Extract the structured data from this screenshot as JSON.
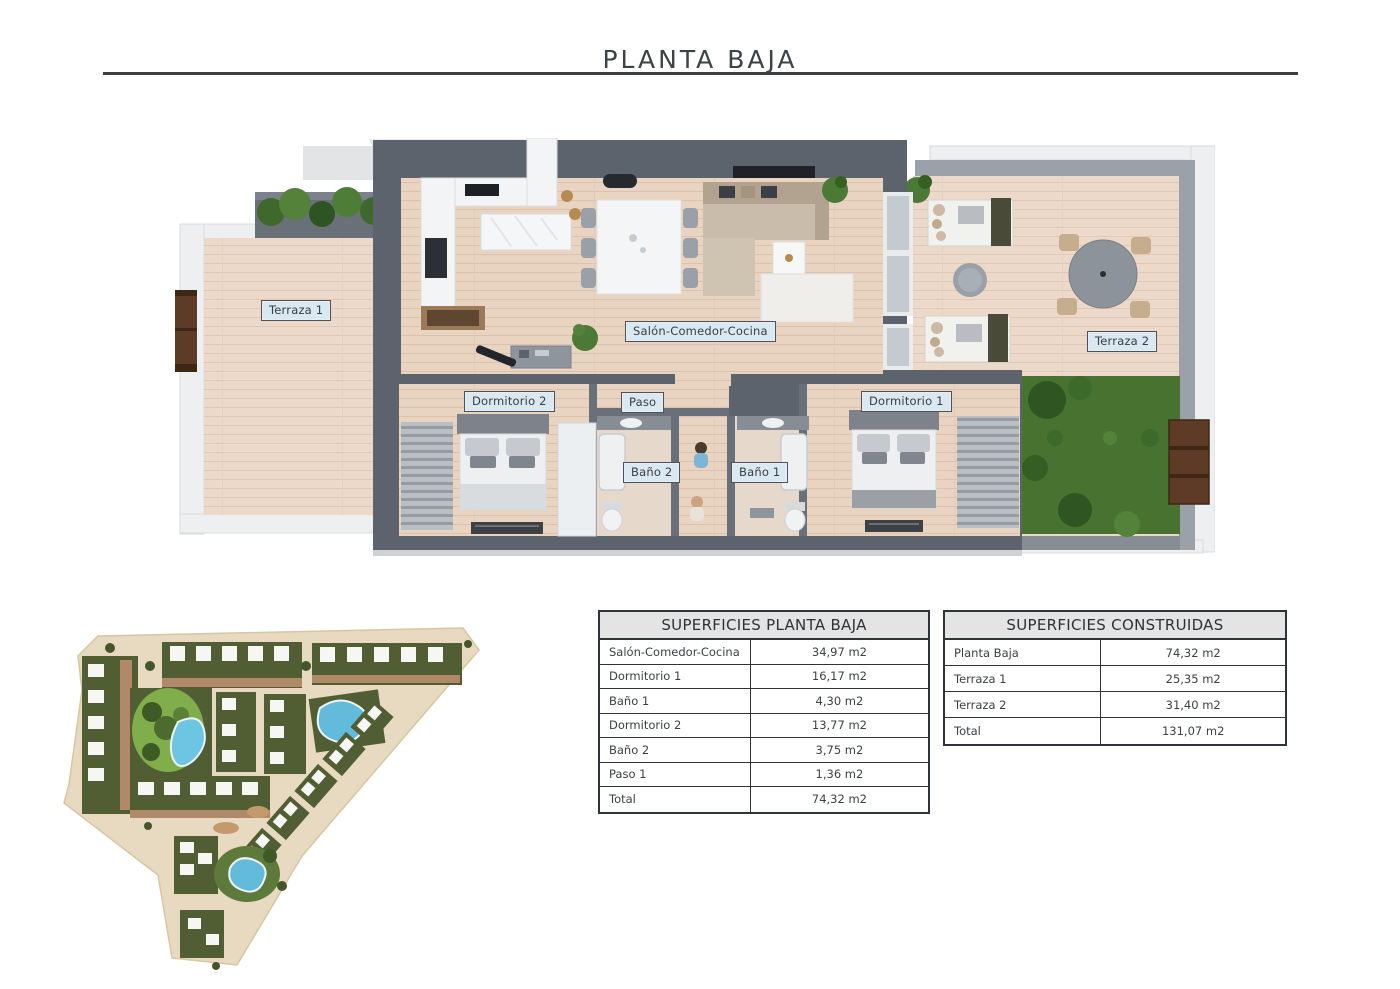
{
  "page": {
    "title": "PLANTA BAJA"
  },
  "floor_plan": {
    "labels": [
      {
        "id": "terraza-1",
        "text": "Terraza 1"
      },
      {
        "id": "salon",
        "text": "Salón-Comedor-Cocina"
      },
      {
        "id": "terraza-2",
        "text": "Terraza 2"
      },
      {
        "id": "dormitorio-2",
        "text": "Dormitorio 2"
      },
      {
        "id": "paso",
        "text": "Paso"
      },
      {
        "id": "dormitorio-1",
        "text": "Dormitorio 1"
      },
      {
        "id": "bano-2",
        "text": "Baño 2"
      },
      {
        "id": "bano-1",
        "text": "Baño 1"
      }
    ]
  },
  "tables": {
    "planta_baja": {
      "title": "SUPERFICIES PLANTA BAJA",
      "rows": [
        {
          "label": "Salón-Comedor-Cocina",
          "value": "34,97 m2"
        },
        {
          "label": "Dormitorio 1",
          "value": "16,17 m2"
        },
        {
          "label": "Baño 1",
          "value": "4,30 m2"
        },
        {
          "label": "Dormitorio 2",
          "value": "13,77 m2"
        },
        {
          "label": "Baño 2",
          "value": "3,75 m2"
        },
        {
          "label": "Paso 1",
          "value": "1,36 m2"
        },
        {
          "label": "Total",
          "value": "74,32 m2"
        }
      ]
    },
    "construidas": {
      "title": "SUPERFICIES CONSTRUIDAS",
      "rows": [
        {
          "label": "Planta Baja",
          "value": "74,32 m2"
        },
        {
          "label": "Terraza 1",
          "value": "25,35 m2"
        },
        {
          "label": "Terraza 2",
          "value": "31,40 m2"
        },
        {
          "label": "Total",
          "value": "131,07 m2"
        }
      ]
    }
  },
  "colors": {
    "label_bg": "#d9e8f1",
    "wall_dark": "#5d636c",
    "wall_mid": "#9ba1a9",
    "wood_floor": "#e9d3c1",
    "terrace_wood": "#ecd9ca",
    "grass": "#48722f",
    "pool_blue": "#62bbdb",
    "site_tan": "#e7dac0",
    "site_green": "#515e33",
    "door_brown": "#5e3b27"
  }
}
